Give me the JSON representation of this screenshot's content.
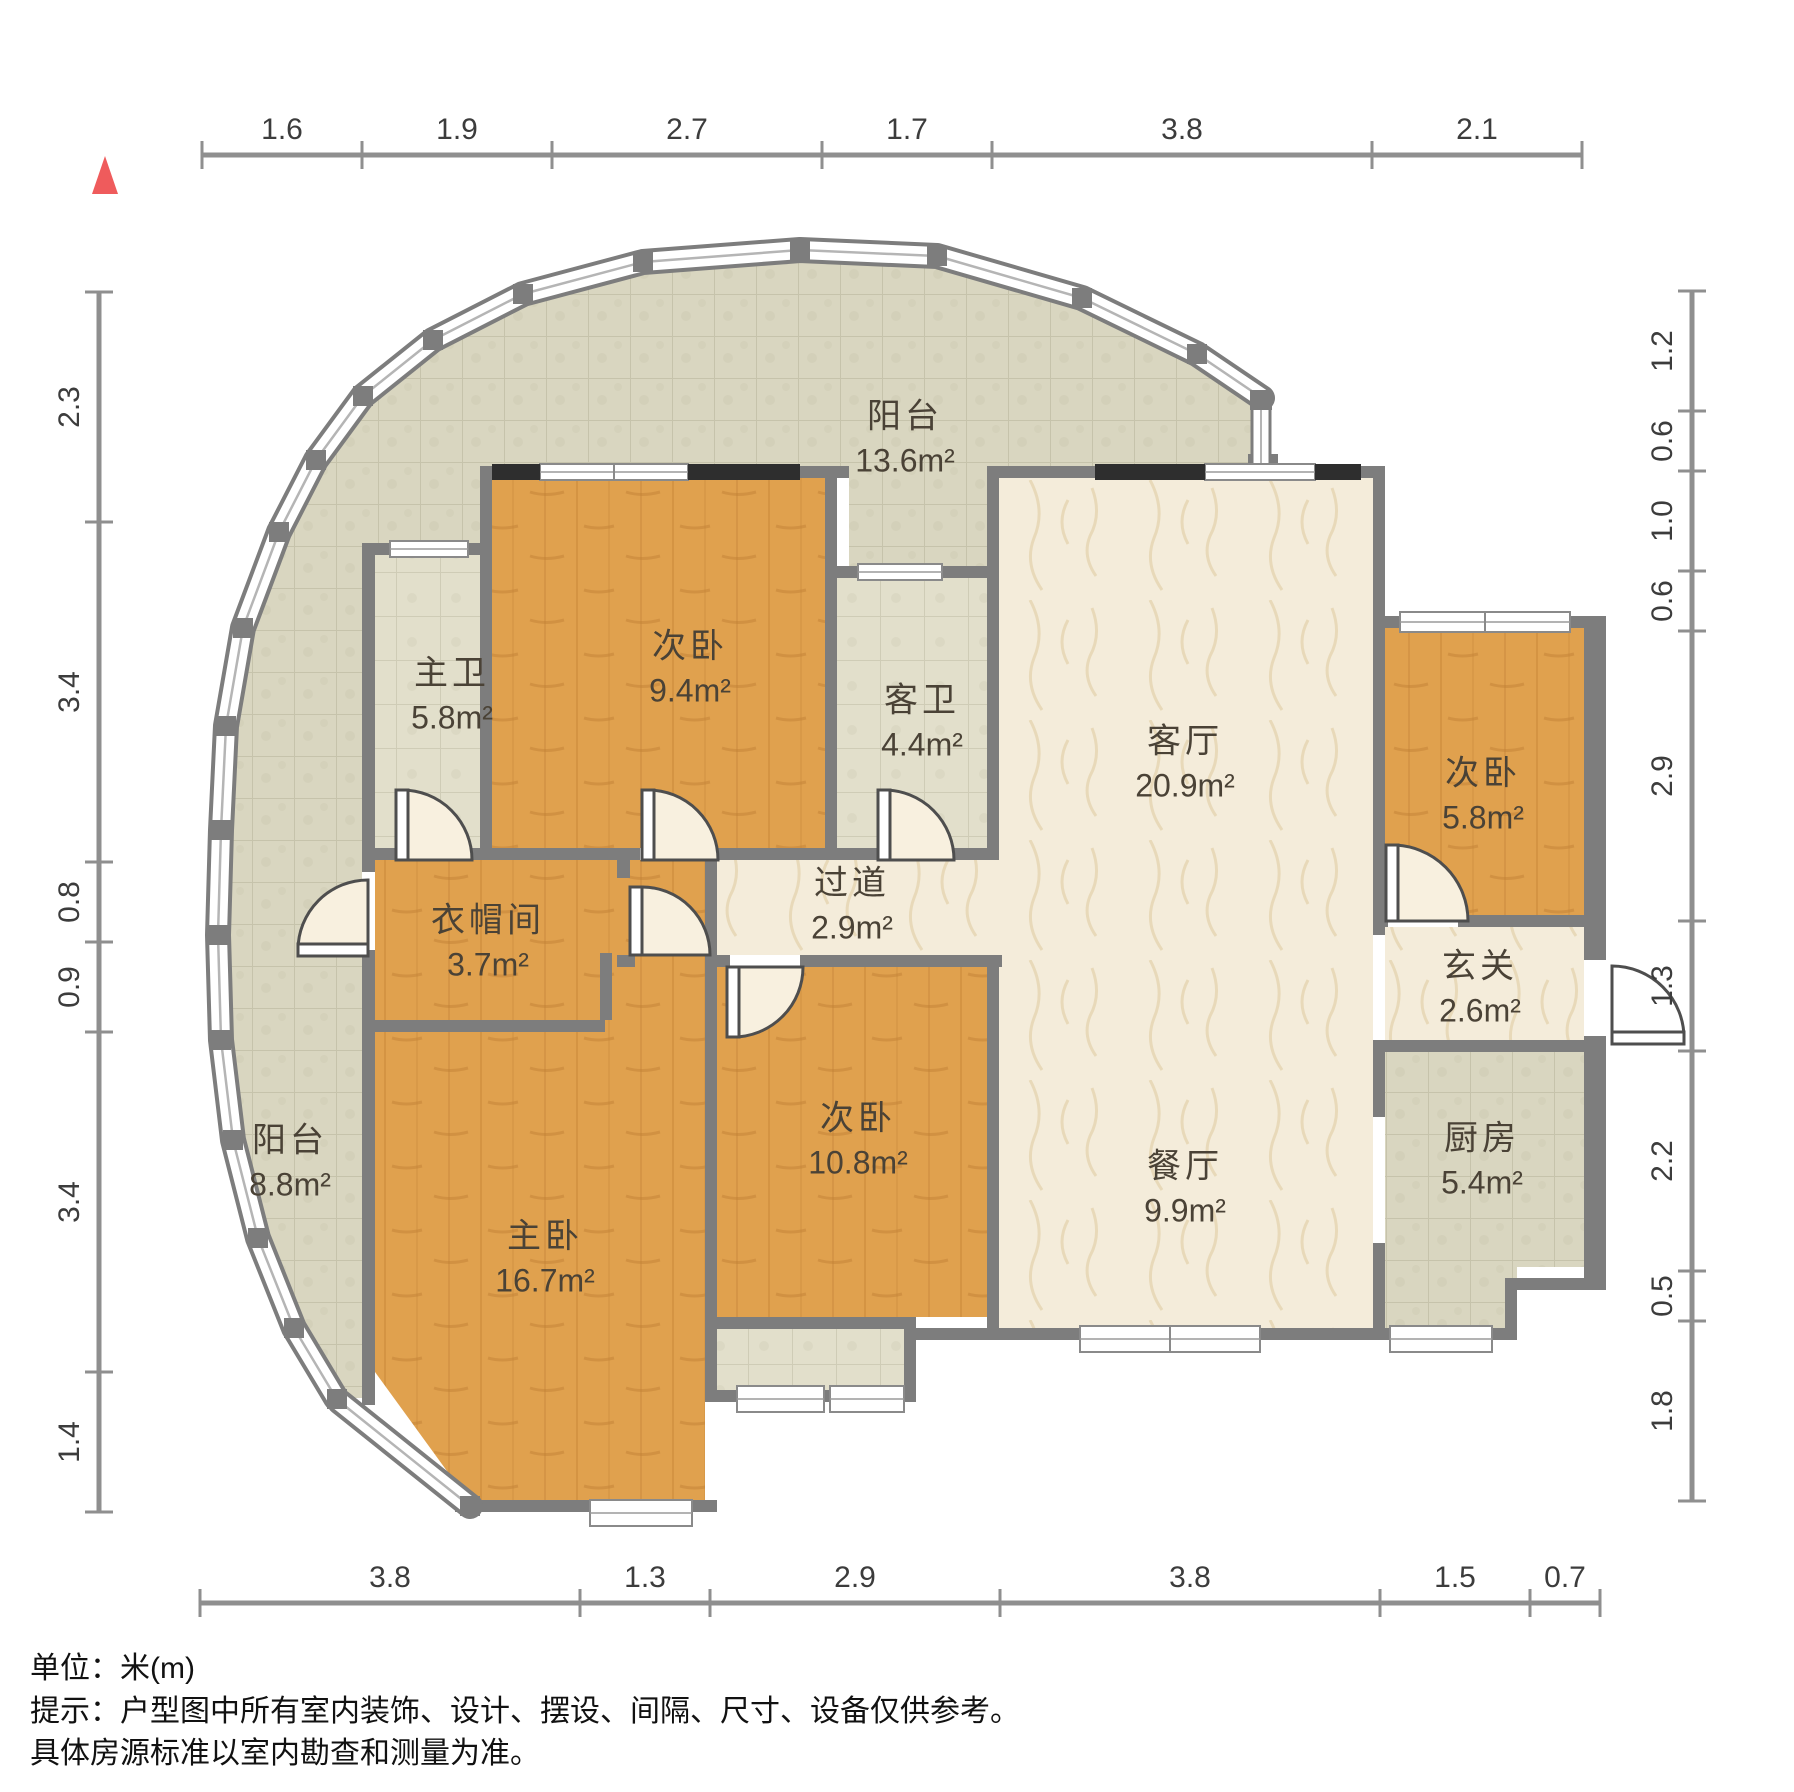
{
  "north": {
    "color": "#ef5b5c"
  },
  "dimensions": {
    "unit_note": "单位：米(m)",
    "top": [
      "1.6",
      "1.9",
      "2.7",
      "1.7",
      "3.8",
      "2.1"
    ],
    "bottom": [
      "3.8",
      "1.3",
      "2.9",
      "3.8",
      "1.5",
      "0.7"
    ],
    "left": [
      "2.3",
      "3.4",
      "0.8",
      "0.9",
      "3.4",
      "1.4"
    ],
    "right": [
      "1.2",
      "0.6",
      "1.0",
      "0.6",
      "2.9",
      "1.3",
      "2.2",
      "0.5",
      "1.8"
    ]
  },
  "rooms": [
    {
      "id": "balcony-top",
      "name": "阳台",
      "area": "13.6m²"
    },
    {
      "id": "master-bath",
      "name": "主卫",
      "area": "5.8m²"
    },
    {
      "id": "bedroom-2",
      "name": "次卧",
      "area": "9.4m²"
    },
    {
      "id": "guest-bath",
      "name": "客卫",
      "area": "4.4m²"
    },
    {
      "id": "living-room",
      "name": "客厅",
      "area": "20.9m²"
    },
    {
      "id": "bedroom-3",
      "name": "次卧",
      "area": "5.8m²"
    },
    {
      "id": "hallway",
      "name": "过道",
      "area": "2.9m²"
    },
    {
      "id": "cloakroom",
      "name": "衣帽间",
      "area": "3.7m²"
    },
    {
      "id": "foyer",
      "name": "玄关",
      "area": "2.6m²"
    },
    {
      "id": "balcony-left",
      "name": "阳台",
      "area": "8.8m²"
    },
    {
      "id": "master-bed",
      "name": "主卧",
      "area": "16.7m²"
    },
    {
      "id": "bedroom-4",
      "name": "次卧",
      "area": "10.8m²"
    },
    {
      "id": "dining-room",
      "name": "餐厅",
      "area": "9.9m²"
    },
    {
      "id": "kitchen",
      "name": "厨房",
      "area": "5.4m²"
    }
  ],
  "footer": {
    "line1": "单位：米(m)",
    "line2": "提示：户型图中所有室内装饰、设计、摆设、间隔、尺寸、设备仅供参考。",
    "line3": "具体房源标准以室内勘查和测量为准。"
  },
  "colors": {
    "wall": "#7d7d7d",
    "wood": "#e0a14e",
    "marble": "#f4ecda",
    "tile_balcony": "#d9d6c0",
    "tile_bath": "#e2dfcb",
    "window_dark": "#2e2e2e",
    "dim_line": "#8f8f8f",
    "dim_text": "#3c3c3c"
  }
}
